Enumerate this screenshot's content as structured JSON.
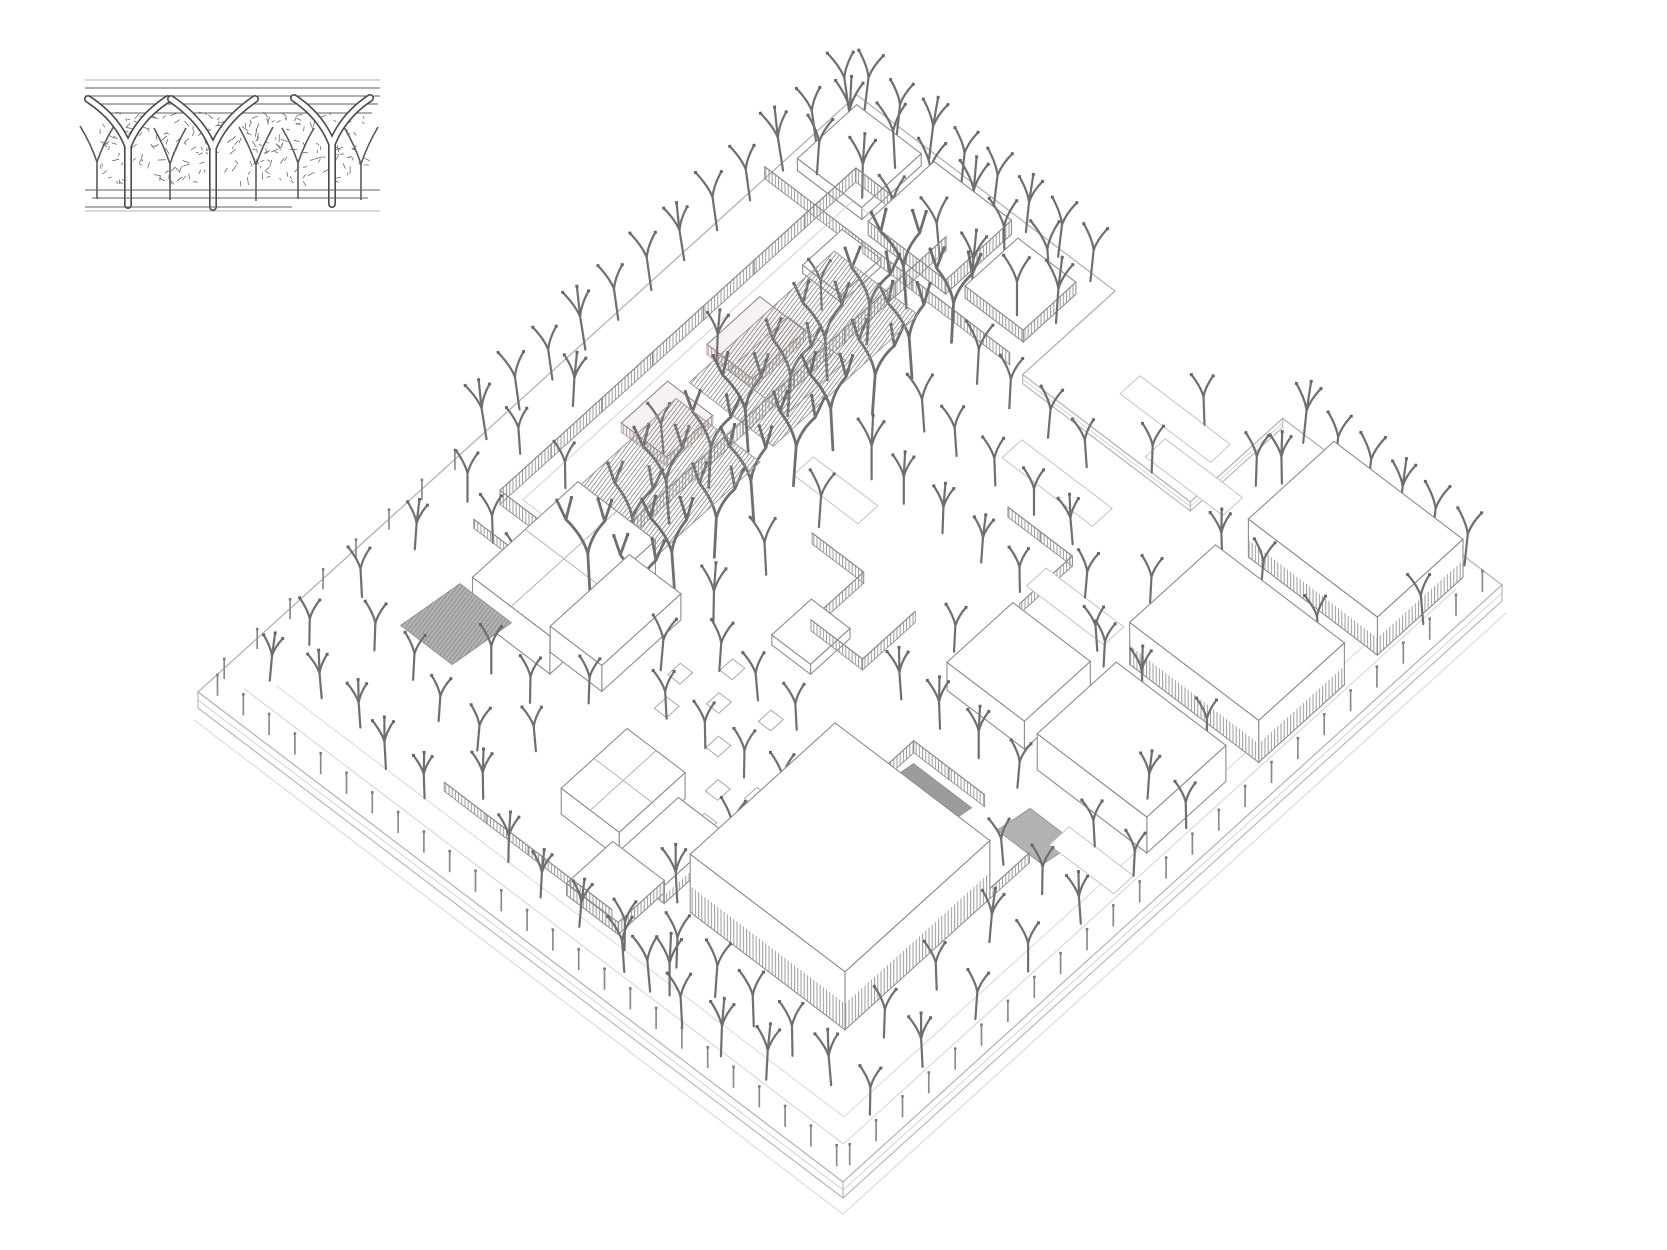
{
  "canvas": {
    "width": 1667,
    "height": 1250,
    "background": "#ffffff"
  },
  "colors": {
    "slabLine": "#b3b3b3",
    "curb": "#c9c9c9",
    "ground": "#d6d6d6",
    "outline": "#8d8d8d",
    "tree": "#6f6f6f",
    "treeCap": "#676767",
    "post": "#8a8a8a",
    "hatch": "#9a9a9a",
    "warmHatch": "#b59c99",
    "warmBg": "#f3ecea",
    "roofHatch": "#8f8f8f",
    "insetInk": "#4f4f4f",
    "rampDark": "#9c9c9c",
    "rampLight": "#b2b2b2",
    "pathLine": "#bdbdbd"
  },
  "inset": {
    "border_lines": [
      [
        85,
        80,
        380,
        80
      ],
      [
        85,
        211,
        380,
        211
      ]
    ],
    "roof_lines": [
      [
        85,
        88,
        380,
        88
      ],
      [
        85,
        96,
        380,
        96
      ],
      [
        88,
        104,
        378,
        104
      ],
      [
        100,
        113,
        372,
        113
      ]
    ],
    "big_columns": [
      {
        "x": 128,
        "base": 205,
        "split": 142,
        "spread": 40,
        "apex": 99
      },
      {
        "x": 213,
        "base": 207,
        "split": 144,
        "spread": 42,
        "apex": 99
      },
      {
        "x": 332,
        "base": 204,
        "split": 140,
        "spread": 38,
        "apex": 98
      }
    ],
    "small_columns": [
      {
        "x": 97,
        "base": 199,
        "split": 162,
        "spread": 17,
        "apex": 126
      },
      {
        "x": 170,
        "base": 200,
        "split": 164,
        "spread": 16,
        "apex": 128
      },
      {
        "x": 256,
        "base": 201,
        "split": 165,
        "spread": 17,
        "apex": 127
      },
      {
        "x": 298,
        "base": 199,
        "split": 163,
        "spread": 16,
        "apex": 128
      },
      {
        "x": 361,
        "base": 200,
        "split": 164,
        "spread": 17,
        "apex": 127
      }
    ],
    "scribble": {
      "x": 100,
      "y": 112,
      "w": 265,
      "h": 70,
      "count": 240,
      "seed": 7
    },
    "ground_lines": [
      [
        85,
        190,
        380,
        190
      ],
      [
        92,
        198,
        368,
        198
      ],
      [
        85,
        207,
        292,
        207
      ]
    ]
  },
  "scene": {
    "origin": {
      "x": 857,
      "y": 95
    },
    "axes": {
      "ax": 6.45,
      "ay": 4.9,
      "bx": 6.59,
      "by": 5.97
    },
    "slab": {
      "outline": [
        [
          0,
          0
        ],
        [
          40,
          0
        ],
        [
          40,
          14
        ],
        [
          66,
          14
        ],
        [
          66,
          0
        ],
        [
          100,
          0
        ],
        [
          100,
          100
        ],
        [
          0,
          100
        ]
      ],
      "notch_faces": [
        [
          [
            40,
            14
          ],
          [
            66,
            14
          ]
        ],
        [
          [
            66,
            14
          ],
          [
            66,
            0
          ]
        ]
      ],
      "thickness": 16
    },
    "buildings": [
      {
        "u": 2,
        "v": 2,
        "du": 10,
        "dv": 9,
        "h": 12,
        "style": "white"
      },
      {
        "u": 14,
        "v": 2,
        "du": 12,
        "dv": 10,
        "h": 14,
        "style": "hatch"
      },
      {
        "u": 28,
        "v": 3,
        "du": 9,
        "dv": 8,
        "h": 12,
        "style": "hatch"
      },
      {
        "u": 76,
        "v": 2,
        "du": 20,
        "dv": 13,
        "h": 38,
        "style": "white",
        "baseHatch": true
      },
      {
        "u": 76,
        "v": 20,
        "du": 20,
        "dv": 13,
        "h": 42,
        "style": "white",
        "baseHatch": true
      },
      {
        "u": 78,
        "v": 37,
        "du": 17,
        "dv": 12,
        "h": 36,
        "style": "white"
      },
      {
        "u": 63,
        "v": 38,
        "du": 12,
        "dv": 10,
        "h": 28,
        "style": "white"
      },
      {
        "u": 62,
        "v": 64,
        "du": 24,
        "dv": 22,
        "h": 58,
        "style": "white",
        "baseHatch": true
      },
      {
        "u": 16,
        "v": 58,
        "du": 12,
        "dv": 16,
        "h": 38,
        "style": "white",
        "roofDiv": true
      },
      {
        "u": 26,
        "v": 60,
        "du": 8,
        "dv": 12,
        "h": 26,
        "style": "white"
      },
      {
        "u": 42,
        "v": 76,
        "du": 9,
        "dv": 10,
        "h": 26,
        "style": "white",
        "roofDiv": true
      },
      {
        "u": 52,
        "v": 78,
        "du": 7,
        "dv": 9,
        "h": 18,
        "style": "white",
        "baseHatch": true
      },
      {
        "u": 50,
        "v": 86,
        "du": 8,
        "dv": 7,
        "h": 12,
        "style": "hatch"
      },
      {
        "u": 44,
        "v": 50,
        "du": 6,
        "dv": 6,
        "h": 10,
        "style": "white"
      },
      {
        "u": 12,
        "v": 14,
        "du": 6,
        "dv": 6,
        "h": 8,
        "style": "white"
      },
      {
        "u": 11.5,
        "v": 26,
        "du": 7,
        "dv": 8,
        "h": 10,
        "style": "warm"
      },
      {
        "u": 11.5,
        "v": 40,
        "du": 7,
        "dv": 7,
        "h": 9,
        "style": "warm"
      }
    ],
    "court": {
      "floor": [
        9.5,
        10,
        20.5,
        60
      ]
    },
    "fences": [
      {
        "a": [
          8,
          8
        ],
        "b": [
          22,
          8
        ],
        "h": 14
      },
      {
        "a": [
          22,
          8
        ],
        "b": [
          22,
          62
        ],
        "h": 14
      },
      {
        "a": [
          8,
          62
        ],
        "b": [
          22,
          62
        ],
        "h": 14
      },
      {
        "a": [
          8,
          8
        ],
        "b": [
          8,
          62
        ],
        "h": 14
      },
      {
        "a": [
          38,
          44
        ],
        "b": [
          46,
          44
        ],
        "h": 11
      },
      {
        "a": [
          46,
          44
        ],
        "b": [
          46,
          52
        ],
        "h": 11
      },
      {
        "a": [
          46,
          52
        ],
        "b": [
          54,
          52
        ],
        "h": 11
      },
      {
        "a": [
          54,
          44
        ],
        "b": [
          54,
          52
        ],
        "h": 11
      },
      {
        "a": [
          52,
          28
        ],
        "b": [
          62,
          28
        ],
        "h": 10
      },
      {
        "a": [
          62,
          28
        ],
        "b": [
          62,
          36
        ],
        "h": 10
      },
      {
        "a": [
          0,
          14
        ],
        "b": [
          38,
          14
        ],
        "h": 12
      },
      {
        "a": [
          30,
          92
        ],
        "b": [
          56,
          92
        ],
        "h": 9
      },
      {
        "a": [
          8,
          66
        ],
        "b": [
          16,
          66
        ],
        "h": 9
      },
      {
        "a": [
          66,
          56
        ],
        "b": [
          77,
          56
        ],
        "h": 12
      },
      {
        "a": [
          66,
          56
        ],
        "b": [
          66,
          65
        ],
        "h": 12
      },
      {
        "a": [
          86,
          58
        ],
        "b": [
          86,
          66
        ],
        "h": 10
      }
    ],
    "spine_roofs": [
      {
        "u": 21,
        "v": 24,
        "du": 13,
        "dv": 22,
        "h": 90
      },
      {
        "u": 21,
        "v": 48,
        "du": 13,
        "dv": 18,
        "h": 86
      },
      {
        "u": 23,
        "v": 33,
        "du": 9,
        "dv": 9,
        "h": 88
      }
    ],
    "ramps": [
      {
        "u": 67,
        "v": 57,
        "du": 9,
        "dv": 8,
        "h": 12,
        "fill": "dark"
      },
      {
        "u": 81,
        "v": 53,
        "du": 7,
        "dv": 5,
        "h": 8,
        "fill": "light"
      },
      {
        "u": 12,
        "v": 72,
        "du": 8,
        "dv": 9,
        "h": 12,
        "fill": "light",
        "hatch": true
      }
    ],
    "paths": [
      [
        50,
        6,
        14,
        3
      ],
      [
        58,
        10,
        12,
        3
      ],
      [
        46,
        20,
        14,
        3
      ],
      [
        74,
        28,
        16,
        3
      ],
      [
        30,
        36,
        10,
        3
      ],
      [
        86,
        52,
        10,
        3
      ],
      [
        60,
        30,
        12,
        3
      ]
    ],
    "planters": [
      [
        44,
        64
      ],
      [
        48,
        68
      ],
      [
        52,
        72
      ],
      [
        46,
        74
      ],
      [
        40,
        68
      ],
      [
        50,
        62
      ],
      [
        54,
        76
      ],
      [
        42,
        60
      ],
      [
        38,
        64
      ],
      [
        56,
        70
      ]
    ],
    "post_rows": [
      {
        "edge": "u",
        "fixed": 99,
        "from": 2,
        "to": 98,
        "step": 4,
        "h": 21
      },
      {
        "edge": "v",
        "fixed": 99,
        "from": 2,
        "to": 98,
        "step": 4,
        "h": 21
      },
      {
        "edge": "u",
        "fixed": 1,
        "from": 62,
        "to": 97,
        "step": 5,
        "h": 20
      }
    ],
    "trees": [
      [
        0.8,
        2,
        64,
        -8
      ],
      [
        0.8,
        7,
        58,
        -8
      ],
      [
        0.8,
        12,
        64,
        -9
      ],
      [
        0.8,
        17,
        60,
        -8
      ],
      [
        0.8,
        22,
        64,
        -8
      ],
      [
        0.8,
        27,
        58,
        -9
      ],
      [
        0.8,
        32,
        63,
        -8
      ],
      [
        0.8,
        37,
        60,
        -8
      ],
      [
        0.8,
        42,
        64,
        -9
      ],
      [
        0.8,
        47,
        58,
        -8
      ],
      [
        0.8,
        52,
        63,
        -8
      ],
      [
        0.8,
        57,
        60,
        -9
      ],
      [
        2,
        0.8,
        62,
        7
      ],
      [
        7,
        0.8,
        57,
        6
      ],
      [
        12,
        0.8,
        62,
        7
      ],
      [
        17,
        0.8,
        58,
        6
      ],
      [
        22,
        0.8,
        62,
        7
      ],
      [
        27,
        0.8,
        58,
        6
      ],
      [
        32,
        0.8,
        62,
        7
      ],
      [
        37,
        0.8,
        60,
        6
      ],
      [
        70,
        0.8,
        62,
        6
      ],
      [
        75,
        0.8,
        58,
        5
      ],
      [
        80,
        0.8,
        62,
        6
      ],
      [
        85,
        0.8,
        58,
        5
      ],
      [
        90,
        0.8,
        62,
        6
      ],
      [
        95,
        0.8,
        60,
        6
      ],
      [
        4,
        5,
        68
      ],
      [
        4,
        10,
        62
      ],
      [
        10,
        4,
        70
      ],
      [
        10,
        9,
        64
      ],
      [
        16,
        5,
        68
      ],
      [
        16,
        10,
        62
      ],
      [
        22,
        4,
        70
      ],
      [
        22,
        9,
        64
      ],
      [
        28,
        5,
        68
      ],
      [
        28,
        10,
        62
      ],
      [
        34,
        4,
        70
      ],
      [
        34,
        9,
        64
      ],
      [
        38,
        7,
        66
      ],
      [
        24,
        16,
        100,
        -4,
        1.35
      ],
      [
        24,
        22,
        96,
        4,
        1.35
      ],
      [
        24,
        28,
        100,
        -3,
        1.35
      ],
      [
        24,
        34,
        96,
        4,
        1.35
      ],
      [
        24,
        40,
        100,
        -4,
        1.35
      ],
      [
        24,
        46,
        96,
        3,
        1.35
      ],
      [
        24,
        52,
        100,
        -4,
        1.35
      ],
      [
        24,
        58,
        96,
        4,
        1.35
      ],
      [
        24,
        64,
        98,
        -3,
        1.35
      ],
      [
        31,
        16,
        94,
        3,
        1.25
      ],
      [
        31,
        22,
        98,
        -4,
        1.25
      ],
      [
        31,
        28,
        94,
        4,
        1.25
      ],
      [
        31,
        34,
        98,
        -3,
        1.25
      ],
      [
        31,
        40,
        94,
        4,
        1.25
      ],
      [
        31,
        46,
        98,
        -4,
        1.25
      ],
      [
        31,
        52,
        94,
        3,
        1.25
      ],
      [
        31,
        58,
        98,
        -4,
        1.25
      ],
      [
        31,
        64,
        94,
        3,
        1.25
      ],
      [
        37,
        18,
        66
      ],
      [
        37,
        26,
        62
      ],
      [
        37,
        34,
        64
      ],
      [
        37,
        42,
        60
      ],
      [
        37,
        50,
        62
      ],
      [
        37,
        58,
        60
      ],
      [
        37,
        66,
        58
      ],
      [
        17,
        22,
        54
      ],
      [
        13,
        34,
        52
      ],
      [
        17,
        46,
        54
      ],
      [
        12,
        56,
        50
      ],
      [
        5,
        48,
        54
      ],
      [
        5,
        56,
        50
      ],
      [
        5,
        64,
        54
      ],
      [
        5,
        72,
        50
      ],
      [
        5,
        80,
        54
      ],
      [
        5,
        88,
        50
      ],
      [
        5,
        94,
        48
      ],
      [
        11,
        66,
        52
      ],
      [
        11,
        84,
        52
      ],
      [
        11,
        92,
        48
      ],
      [
        17,
        68,
        54
      ],
      [
        17,
        84,
        50
      ],
      [
        17,
        92,
        48
      ],
      [
        23,
        78,
        52
      ],
      [
        23,
        86,
        48
      ],
      [
        23,
        94,
        52
      ],
      [
        29,
        78,
        50
      ],
      [
        29,
        86,
        48
      ],
      [
        29,
        94,
        46
      ],
      [
        34,
        74,
        50
      ],
      [
        34,
        82,
        48
      ],
      [
        34,
        90,
        50
      ],
      [
        42,
        18,
        56
      ],
      [
        42,
        26,
        54
      ],
      [
        42,
        34,
        52
      ],
      [
        42,
        62,
        54
      ],
      [
        42,
        70,
        52
      ],
      [
        42,
        94,
        50
      ],
      [
        48,
        18,
        54
      ],
      [
        48,
        26,
        52
      ],
      [
        48,
        34,
        50
      ],
      [
        48,
        62,
        52
      ],
      [
        48,
        70,
        50
      ],
      [
        48,
        95,
        48
      ],
      [
        54,
        18,
        52
      ],
      [
        54,
        26,
        50
      ],
      [
        54,
        34,
        48
      ],
      [
        54,
        62,
        50
      ],
      [
        54,
        70,
        52
      ],
      [
        54,
        95,
        48
      ],
      [
        60,
        6,
        54
      ],
      [
        60,
        14,
        52
      ],
      [
        60,
        26,
        50
      ],
      [
        60,
        34,
        48
      ],
      [
        60,
        44,
        50
      ],
      [
        60,
        52,
        52
      ],
      [
        60,
        70,
        58
      ],
      [
        60,
        78,
        60
      ],
      [
        60,
        86,
        58
      ],
      [
        60,
        94,
        54
      ],
      [
        66,
        30,
        50
      ],
      [
        66,
        52,
        52
      ],
      [
        66,
        92,
        58
      ],
      [
        66,
        96,
        60
      ],
      [
        72,
        6,
        52
      ],
      [
        72,
        26,
        50
      ],
      [
        72,
        34,
        48
      ],
      [
        72,
        52,
        52
      ],
      [
        72,
        92,
        60
      ],
      [
        72,
        97,
        58
      ],
      [
        78,
        30,
        48
      ],
      [
        78,
        52,
        50
      ],
      [
        78,
        92,
        60
      ],
      [
        78,
        97,
        58
      ],
      [
        84,
        60,
        50
      ],
      [
        84,
        92,
        58
      ],
      [
        84,
        96,
        56
      ],
      [
        90,
        18,
        52
      ],
      [
        90,
        35,
        50
      ],
      [
        90,
        44,
        48
      ],
      [
        90,
        52,
        50
      ],
      [
        90,
        60,
        52
      ],
      [
        90,
        68,
        54
      ],
      [
        90,
        76,
        52
      ],
      [
        90,
        84,
        54
      ],
      [
        90,
        92,
        56
      ],
      [
        96,
        44,
        50
      ],
      [
        96,
        52,
        48
      ],
      [
        96,
        60,
        52
      ],
      [
        96,
        68,
        54
      ],
      [
        96,
        76,
        52
      ],
      [
        96,
        84,
        54
      ],
      [
        96,
        92,
        52
      ],
      [
        80,
        17,
        52
      ],
      [
        74,
        17,
        50
      ],
      [
        70,
        8,
        56
      ],
      [
        97,
        9,
        54
      ],
      [
        80,
        35,
        50
      ],
      [
        74,
        35,
        48
      ],
      [
        62,
        96,
        60
      ],
      [
        68,
        95,
        62
      ]
    ]
  }
}
